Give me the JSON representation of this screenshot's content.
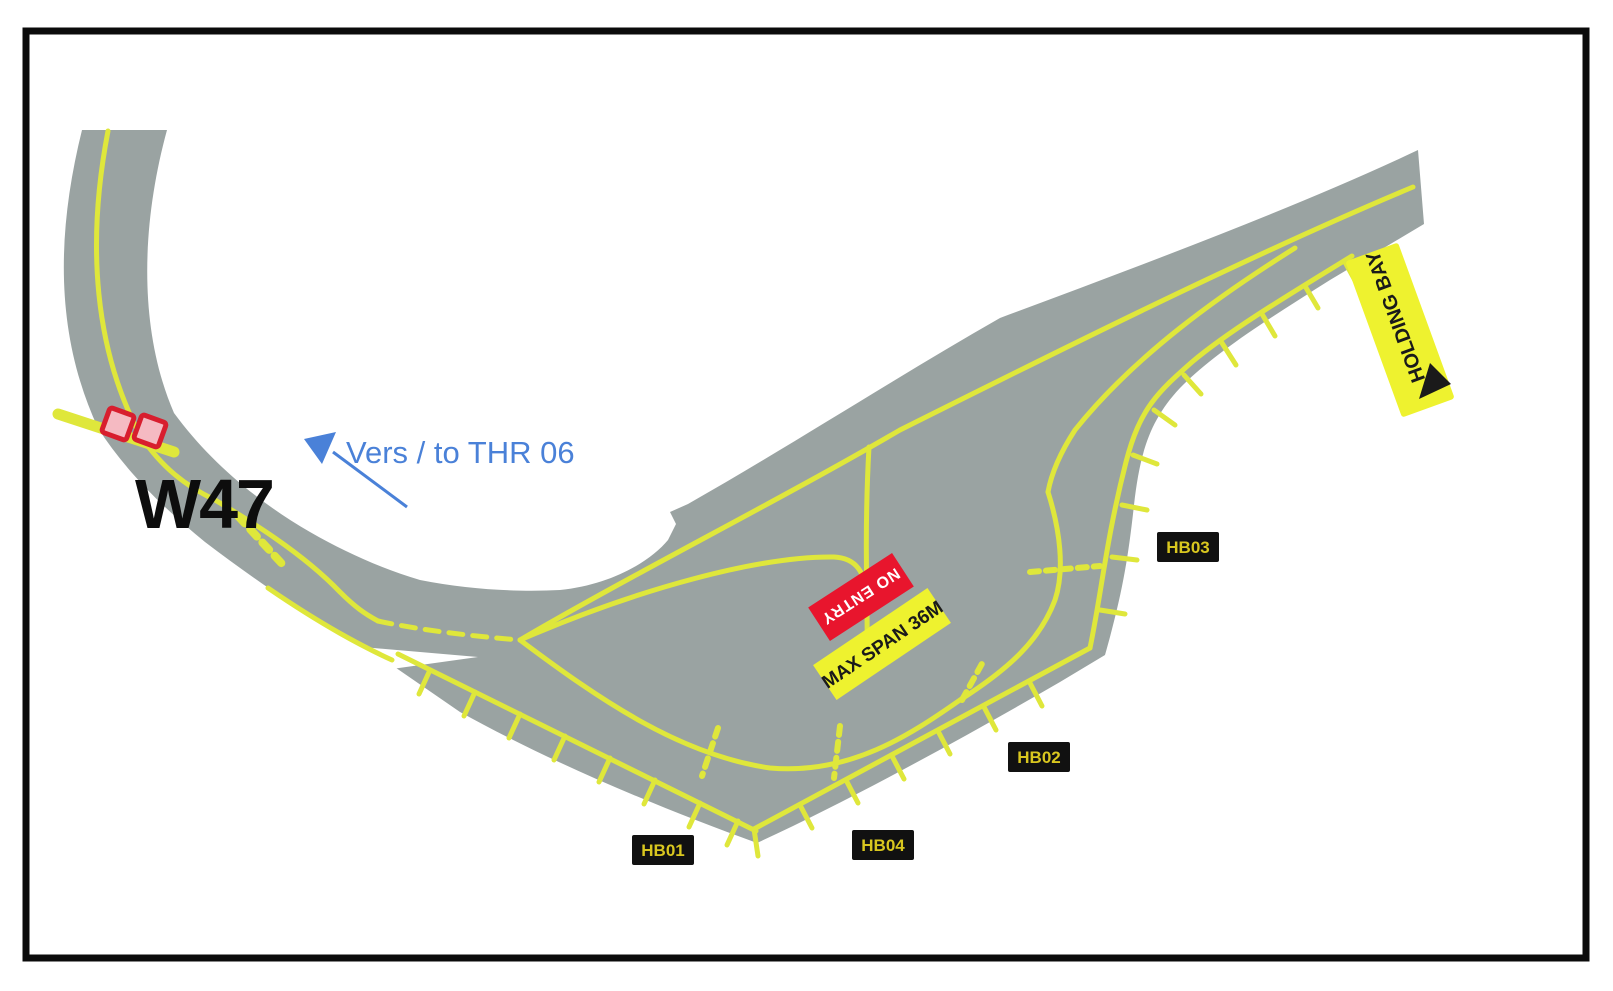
{
  "diagram": {
    "kind": "airport-holding-bay-diagram",
    "taxiway_label": "W47",
    "direction_note": "Vers / to THR 06",
    "signs": {
      "no_entry": "NO ENTRY",
      "max_span": "MAX SPAN 36M",
      "holding_bay": "HOLDING BAY"
    },
    "holding_positions": {
      "hb01": "HB01",
      "hb02": "HB02",
      "hb03": "HB03",
      "hb04": "HB04"
    },
    "colors": {
      "border": "#0b0b0b",
      "pavement": "#9aa3a2",
      "marking_yellow": "#dfe73b",
      "sign_red": "#e8152d",
      "sign_red_text": "#ffffff",
      "sign_yellow": "#eef22f",
      "sign_yellow_text": "#1a1a1a",
      "label_bg": "#111111",
      "label_text": "#d9c71f",
      "note_blue": "#4a81d8",
      "ink_black": "#0d0d0d",
      "guard_light_fill": "#f5bac2",
      "guard_light_stroke": "#d81e2e"
    }
  }
}
